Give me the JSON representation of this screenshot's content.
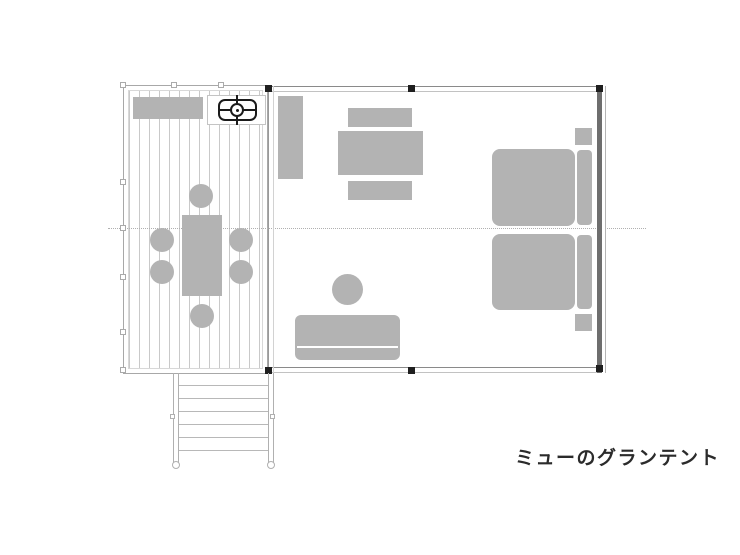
{
  "title": {
    "label": "ミューのグランテント"
  },
  "colors": {
    "furniture": "#b3b3b3",
    "plank_line": "#c9c9c9",
    "wall": "#8a8a8a",
    "wall_light": "#c2c2c2",
    "wall_dark": "#6e6e6e",
    "pole_marker": "#1f1f1f",
    "dotted_line": "#b0b0b0",
    "stove_outline": "#1a1a1a",
    "title_text": "#2b2b2b"
  },
  "plan": {
    "areas": [
      "deck-terrace",
      "tent-interior",
      "entry-steps"
    ],
    "furniture_icons": [
      "deck-bench",
      "bbq-stove",
      "deck-dining-table",
      "deck-chair",
      "storage-shelf",
      "indoor-table",
      "indoor-bench",
      "sofa",
      "ottoman",
      "bed",
      "pillow",
      "nightstand"
    ]
  }
}
